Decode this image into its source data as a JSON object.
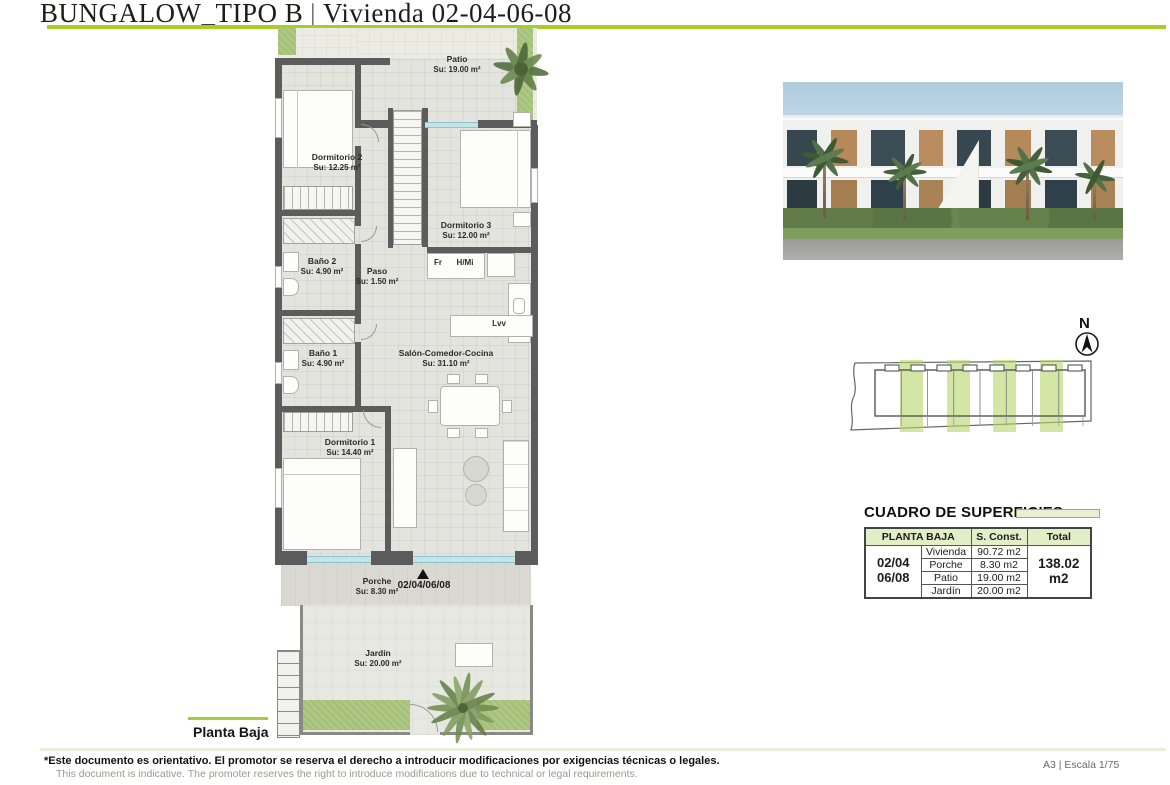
{
  "header": {
    "project": "BUNGALOW_TIPO B",
    "separator": "|",
    "subtitle": "Vivienda 02-04-06-08"
  },
  "floorplan": {
    "caption": "Planta Baja",
    "entrance_code": "02/04/06/08",
    "rooms": [
      {
        "name": "Patio",
        "area": "Su: 19.00 m²"
      },
      {
        "name": "Dormitorio 2",
        "area": "Su: 12.25 m²"
      },
      {
        "name": "Dormitorio 3",
        "area": "Su: 12.00 m²"
      },
      {
        "name": "Baño 2",
        "area": "Su: 4.90 m²"
      },
      {
        "name": "Paso",
        "area": "Su: 1.50 m²"
      },
      {
        "name": "Baño 1",
        "area": "Su: 4.90 m²"
      },
      {
        "name": "Salón-Comedor-Cocina",
        "area": "Su: 31.10 m²"
      },
      {
        "name": "Dormitorio 1",
        "area": "Su: 14.40 m²"
      },
      {
        "name": "Porche",
        "area": "Su: 8.30 m²"
      },
      {
        "name": "Jardín",
        "area": "Su: 20.00 m²"
      }
    ],
    "appliances": {
      "fridge": "Fr",
      "oven_micro": "H/Mi",
      "dishwasher": "Lvv"
    }
  },
  "north": {
    "label": "N"
  },
  "surfaces_table": {
    "title": "CUADRO DE SUPERFICIES",
    "floor_header": "PLANTA BAJA",
    "const_header": "S. Const.",
    "total_header": "Total",
    "unit_line1": "02/04",
    "unit_line2": "06/08",
    "rows": [
      {
        "concept": "Vivienda",
        "value": "90.72 m2"
      },
      {
        "concept": "Porche",
        "value": "8.30 m2"
      },
      {
        "concept": "Patio",
        "value": "19.00 m2"
      },
      {
        "concept": "Jardín",
        "value": "20.00 m2"
      }
    ],
    "total_value": "138.02 m2"
  },
  "footer": {
    "disclaimer_es": "*Este documento es orientativo. El promotor se reserva el derecho a introducir modificaciones por exigencias técnicas o legales.",
    "disclaimer_en": "This document is indicative. The promoter reserves the right to introduce modifications due to technical or legal requirements.",
    "sheet_info": "A3 | Escala 1/75"
  },
  "colors": {
    "accent_green": "#a6ce26",
    "table_green": "#e2eec6",
    "plan_green": "#a5c178"
  }
}
